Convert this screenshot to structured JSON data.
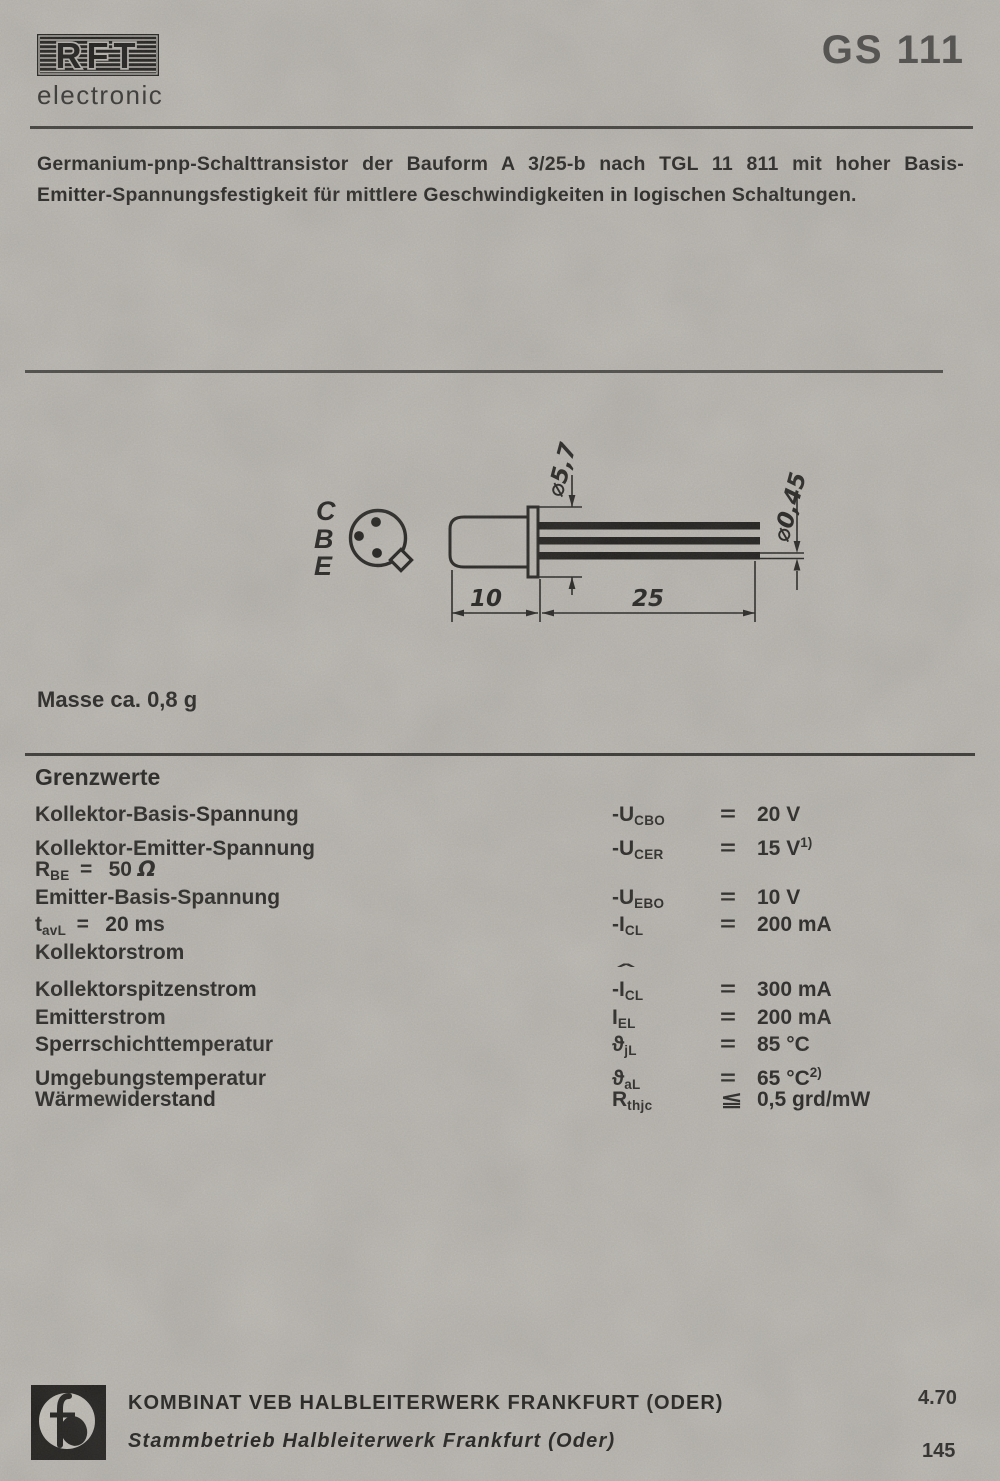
{
  "product_code": "GS 111",
  "brand": {
    "logo_text": "RFT",
    "subtitle": "electronic"
  },
  "description_lines": [
    "Germanium-pnp-Schalttransistor der Bauform A 3/25-b nach TGL 11 811 mit hoher Basis-",
    "Emitter-Spannungsfestigkeit für mittlere Geschwindigkeiten in logischen Schaltungen."
  ],
  "drawing": {
    "pin_labels": [
      "C",
      "B",
      "E"
    ],
    "dims": {
      "body_diameter": "⌀5,7",
      "lead_diameter": "⌀0,45",
      "body_length": "10",
      "lead_length": "25"
    }
  },
  "mass_note": "Masse ca. 0,8 g",
  "limits": {
    "heading": "Grenzwerte",
    "rows": [
      {
        "label": [
          {
            "t": "Kollektor-Basis-Spannung"
          }
        ],
        "sym": [
          {
            "t": "-U"
          },
          {
            "t": "CBO",
            "s": "sub"
          }
        ],
        "sign": "=",
        "value": [
          {
            "t": "20 V"
          }
        ]
      },
      {
        "label": [
          {
            "t": "Kollektor-Emitter-Spannung"
          }
        ],
        "sym": [
          {
            "t": "-U"
          },
          {
            "t": "CER",
            "s": "sub"
          }
        ],
        "sign": "=",
        "value": [
          {
            "t": "15 V"
          },
          {
            "t": "1)",
            "s": "sup"
          }
        ]
      },
      {
        "label": [
          {
            "t": "R"
          },
          {
            "t": "BE",
            "s": "sub"
          },
          {
            "t": " =  50 "
          },
          {
            "t": "Ω",
            "s": "it"
          }
        ]
      },
      {
        "label": [
          {
            "t": "Emitter-Basis-Spannung"
          }
        ],
        "sym": [
          {
            "t": "-U"
          },
          {
            "t": "EBO",
            "s": "sub"
          }
        ],
        "sign": "=",
        "value": [
          {
            "t": "10 V"
          }
        ]
      },
      {
        "label": [
          {
            "t": "t"
          },
          {
            "t": "avL",
            "s": "sub"
          },
          {
            "t": " =  20 ms"
          }
        ],
        "sym": [
          {
            "t": "-I"
          },
          {
            "t": "CL",
            "s": "sub"
          }
        ],
        "sign": "=",
        "value": [
          {
            "t": "200 mA"
          }
        ]
      },
      {
        "label": [
          {
            "t": "Kollektorstrom"
          }
        ]
      },
      {
        "gap": true,
        "label": [
          {
            "t": "Kollektorspitzenstrom"
          }
        ],
        "sym": [
          {
            "t": "-I",
            "hat": true
          },
          {
            "t": "CL",
            "s": "sub"
          }
        ],
        "sign": "=",
        "value": [
          {
            "t": "300 mA"
          }
        ]
      },
      {
        "label": [
          {
            "t": "Emitterstrom"
          }
        ],
        "sym": [
          {
            "t": "I"
          },
          {
            "t": "EL",
            "s": "sub"
          }
        ],
        "sign": "=",
        "value": [
          {
            "t": "200 mA"
          }
        ]
      },
      {
        "label": [
          {
            "t": "Sperrschichttemperatur"
          }
        ],
        "sym": [
          {
            "t": "ϑ"
          },
          {
            "t": "jL",
            "s": "sub"
          }
        ],
        "sign": "=",
        "value": [
          {
            "t": "85 °C"
          }
        ]
      },
      {
        "label": [
          {
            "t": "Umgebungstemperatur"
          }
        ],
        "sym": [
          {
            "t": "ϑ"
          },
          {
            "t": "aL",
            "s": "sub"
          }
        ],
        "sign": "=",
        "value": [
          {
            "t": "65 °C"
          },
          {
            "t": "2)",
            "s": "sup"
          }
        ]
      },
      {
        "label": [
          {
            "t": "Wärmewiderstand"
          }
        ],
        "sym": [
          {
            "t": "R"
          },
          {
            "t": "thjc",
            "s": "sub"
          }
        ],
        "sign": "≦",
        "value": [
          {
            "t": "0,5 grd/mW"
          }
        ]
      }
    ]
  },
  "footer": {
    "company_line1": "KOMBINAT VEB HALBLEITERWERK FRANKFURT (ODER)",
    "company_line2": "Stammbetrieb Halbleiterwerk Frankfurt (Oder)",
    "date_code": "4.70",
    "page_number": "145",
    "logo": "hfo-monogram"
  },
  "colors": {
    "paper": "#cbc8c2",
    "ink": "#1d1c1a",
    "title_gray": "#4c4b49"
  }
}
